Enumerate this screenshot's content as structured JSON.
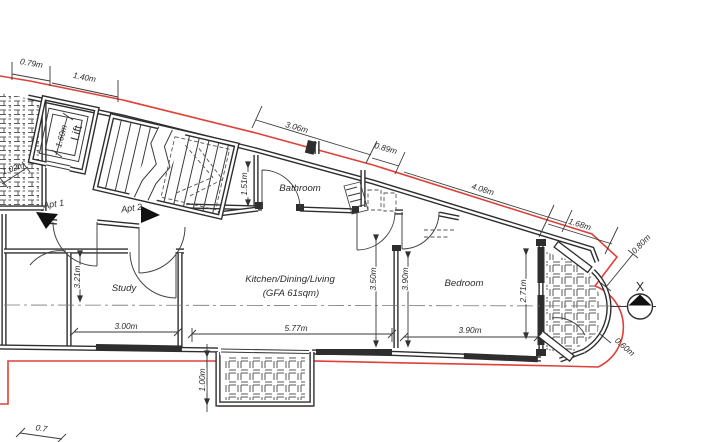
{
  "colors": {
    "outline_red": "#df4038",
    "wall": "#2e2e2e",
    "dim_text": "#2b2b2b"
  },
  "rooms": {
    "lift": "Lift",
    "bathroom": "Bathroom",
    "study": "Study",
    "kitchen_line1": "Kitchen/Dining/Living",
    "kitchen_line2": "(GFA 61sqm)",
    "bedroom": "Bedroom"
  },
  "entrances": {
    "apt1": "Apt 1",
    "apt2": "Apt 2"
  },
  "section_marker": {
    "label": "X"
  },
  "dimensions": {
    "d_079": "0.79m",
    "d_140": "1.40m",
    "d_306": "3.06m",
    "d_089": "0.89m",
    "d_408": "4.08m",
    "d_168": "1.68m",
    "d_080_corner": "0.80m",
    "d_060_bay": "0.60m",
    "d_160_lift": "1.60m",
    "d_102_shaft": "1.02m",
    "d_151_stairs": "1.51m",
    "d_321_study": "3.21m",
    "d_300_study": "3.00m",
    "d_577_kitchen": "5.77m",
    "d_350_kitchen": "3.50m",
    "d_390_bedroom_h": "3.90m",
    "d_390_bedroom_w": "3.90m",
    "d_271_bay": "2.71m",
    "d_100_balcony": "1.00m",
    "d_partial_bottom": "0.7"
  }
}
